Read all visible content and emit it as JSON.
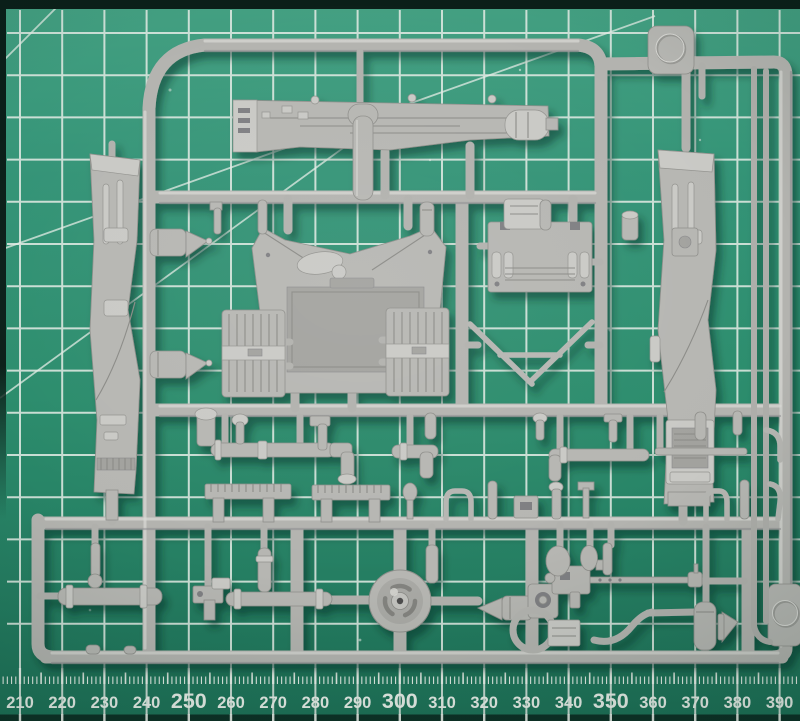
{
  "scene": {
    "type": "photograph",
    "subject": "Light grey injection-moulded model kit sprue (parts tree) lying on a green self-healing cutting mat with a millimetre ruler edge",
    "sprue_plastic_color": "#b5b5b1",
    "mat_color": "#2c8e6e"
  },
  "mat": {
    "grid_line_color": "#e3ece5",
    "border_color": "#0b1f19",
    "grid_spacing_mm": 10
  },
  "ruler": {
    "units": "mm",
    "labels": [
      "210",
      "220",
      "230",
      "240",
      "250",
      "260",
      "270",
      "280",
      "290",
      "300",
      "310",
      "320",
      "330",
      "340",
      "350",
      "360",
      "370",
      "380",
      "390"
    ],
    "emphasized_labels": [
      "250",
      "300",
      "350"
    ],
    "label_color": "#eaf0ea",
    "tick_color": "#edf2ec"
  },
  "sprue": {
    "id_tabs": [
      "top-right-tab",
      "right-edge-tab"
    ],
    "parts": [
      "upper-hull-side",
      "left-fender",
      "right-fender",
      "cab-roof",
      "left-door",
      "right-door",
      "engine-access-panel",
      "v-antenna",
      "exhaust-muffler-1",
      "exhaust-muffler-2",
      "exhaust-tube",
      "elbow-pipe",
      "long-pipe",
      "thin-rod",
      "ladder-strip-1",
      "ladder-strip-2",
      "periscope",
      "road-wheel",
      "axle-rod",
      "cylinder-rod",
      "silencer",
      "gun-mount",
      "machine-gun",
      "turret-ring",
      "tow-hook",
      "ammo-box",
      "assorted-small-fittings"
    ]
  }
}
